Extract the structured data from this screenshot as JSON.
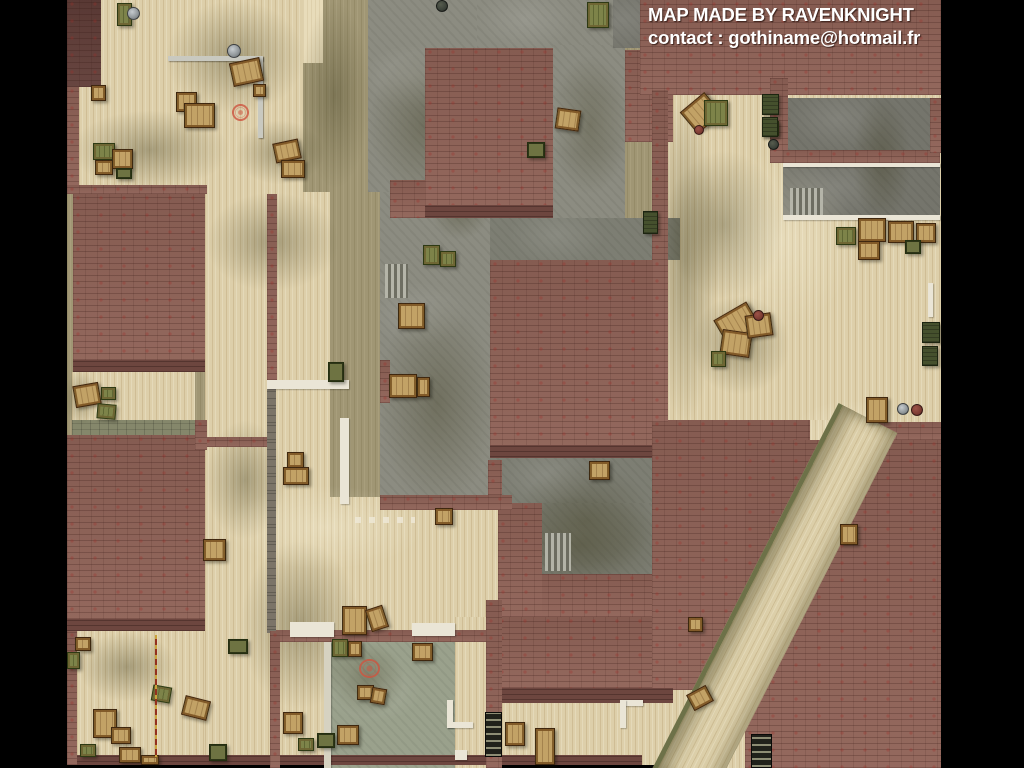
{
  "credits": {
    "line1": "MAP MADE BY RAVENKNIGHT",
    "line2": "contact : gothiname@hotmail.fr"
  },
  "palette": {
    "background": "#000000",
    "brick_roof": "#8d6156",
    "brick_dark": "#5e3c37",
    "wood_floor": "#ddcfaa",
    "olive_floor": "#a09674",
    "concrete": "#8c8c81",
    "concrete_green_room": "#9aa18c",
    "white_wall": "#eae5d6",
    "crate_tan": "#c2a266",
    "crate_green": "#7d8349",
    "marker_red": "#cd5540",
    "text": "#ffffff"
  },
  "map": {
    "width": 1024,
    "height": 768,
    "base": [
      67,
      0,
      874,
      765
    ],
    "floors": [
      [
        79,
        0,
        224,
        192,
        "bone"
      ],
      [
        303,
        0,
        20,
        63,
        "bone-light"
      ],
      [
        72,
        372,
        123,
        50,
        "bone"
      ],
      [
        72,
        420,
        123,
        16,
        "pave"
      ],
      [
        205,
        192,
        125,
        440,
        "bone"
      ],
      [
        77,
        631,
        193,
        126,
        "bone"
      ],
      [
        205,
        631,
        125,
        126,
        "bone"
      ],
      [
        205,
        497,
        447,
        134,
        "bone"
      ],
      [
        666,
        95,
        275,
        327,
        "bone"
      ],
      [
        502,
        703,
        255,
        62,
        "bone"
      ],
      [
        455,
        617,
        31,
        151,
        "bone"
      ],
      [
        655,
        655,
        100,
        113,
        "bone"
      ],
      [
        808,
        420,
        66,
        24,
        "bone"
      ]
    ],
    "concrete": [
      [
        368,
        0,
        122,
        192,
        "std"
      ],
      [
        380,
        192,
        110,
        305,
        "std"
      ],
      [
        477,
        0,
        140,
        48,
        "std"
      ],
      [
        553,
        45,
        72,
        196,
        "std"
      ],
      [
        490,
        218,
        190,
        42,
        "dark"
      ],
      [
        490,
        458,
        162,
        45,
        "dark"
      ],
      [
        542,
        503,
        110,
        71,
        "dark"
      ],
      [
        788,
        98,
        142,
        52,
        "room"
      ],
      [
        783,
        167,
        157,
        48,
        "room"
      ],
      [
        330,
        640,
        125,
        128,
        "green"
      ],
      [
        608,
        600,
        34,
        17,
        "std"
      ],
      [
        613,
        0,
        28,
        48,
        "room"
      ]
    ],
    "shadows": [
      [
        165,
        0,
        140,
        115
      ],
      [
        70,
        110,
        160,
        80
      ],
      [
        235,
        120,
        90,
        65
      ],
      [
        300,
        0,
        70,
        190
      ],
      [
        368,
        50,
        115,
        150
      ],
      [
        378,
        295,
        118,
        215
      ],
      [
        550,
        55,
        80,
        140
      ],
      [
        205,
        192,
        135,
        100
      ],
      [
        205,
        420,
        80,
        120
      ],
      [
        490,
        495,
        180,
        100
      ],
      [
        652,
        95,
        66,
        330
      ],
      [
        664,
        150,
        120,
        150
      ],
      [
        690,
        295,
        100,
        100
      ],
      [
        515,
        462,
        140,
        118
      ],
      [
        770,
        440,
        120,
        200
      ],
      [
        640,
        560,
        130,
        120
      ],
      [
        77,
        632,
        100,
        70
      ],
      [
        330,
        642,
        75,
        75
      ],
      [
        852,
        95,
        60,
        130
      ],
      [
        430,
        180,
        60,
        60
      ],
      [
        64,
        370,
        34,
        56
      ],
      [
        240,
        540,
        120,
        170
      ]
    ],
    "highlights": [
      [
        225,
        485,
        200,
        85
      ],
      [
        705,
        150,
        150,
        180
      ],
      [
        790,
        400,
        120,
        70
      ],
      [
        540,
        640,
        110,
        60
      ]
    ],
    "stairs": [
      [
        385,
        264,
        23,
        34
      ],
      [
        790,
        188,
        33,
        27
      ],
      [
        545,
        533,
        26,
        38
      ]
    ],
    "bricks": [
      [
        67,
        0,
        34,
        87,
        "dark"
      ],
      [
        67,
        87,
        12,
        101,
        ""
      ],
      [
        67,
        185,
        140,
        9,
        ""
      ],
      [
        73,
        194,
        132,
        178,
        ""
      ],
      [
        73,
        360,
        132,
        12,
        "edge"
      ],
      [
        67,
        435,
        138,
        196,
        ""
      ],
      [
        67,
        619,
        138,
        12,
        "edge"
      ],
      [
        203,
        437,
        64,
        10,
        ""
      ],
      [
        425,
        48,
        128,
        170,
        ""
      ],
      [
        425,
        205,
        128,
        13,
        "edge"
      ],
      [
        390,
        180,
        35,
        38,
        ""
      ],
      [
        625,
        50,
        48,
        92,
        ""
      ],
      [
        640,
        0,
        301,
        95,
        ""
      ],
      [
        490,
        260,
        167,
        198,
        ""
      ],
      [
        490,
        445,
        167,
        13,
        "edge"
      ],
      [
        652,
        420,
        158,
        270,
        ""
      ],
      [
        497,
        617,
        155,
        71,
        ""
      ],
      [
        497,
        688,
        176,
        15,
        "edge"
      ],
      [
        512,
        574,
        140,
        43,
        ""
      ],
      [
        498,
        503,
        44,
        114,
        ""
      ],
      [
        488,
        460,
        14,
        47,
        ""
      ],
      [
        745,
        440,
        196,
        328,
        ""
      ],
      [
        872,
        422,
        69,
        18,
        ""
      ],
      [
        770,
        78,
        18,
        85,
        ""
      ],
      [
        783,
        150,
        157,
        13,
        ""
      ],
      [
        930,
        98,
        11,
        55,
        ""
      ],
      [
        652,
        90,
        16,
        332,
        ""
      ],
      [
        380,
        360,
        10,
        43,
        ""
      ],
      [
        380,
        495,
        132,
        15,
        ""
      ],
      [
        67,
        755,
        575,
        10,
        "edge"
      ],
      [
        270,
        630,
        216,
        12,
        ""
      ],
      [
        486,
        600,
        16,
        168,
        ""
      ],
      [
        267,
        389,
        9,
        244,
        "stone"
      ],
      [
        267,
        194,
        10,
        186,
        ""
      ],
      [
        67,
        631,
        10,
        134,
        ""
      ],
      [
        270,
        631,
        10,
        137,
        ""
      ],
      [
        195,
        420,
        12,
        30,
        ""
      ]
    ],
    "whites": [
      [
        267,
        380,
        82,
        9,
        ""
      ],
      [
        340,
        418,
        9,
        86,
        ""
      ],
      [
        783,
        163,
        157,
        4,
        ""
      ],
      [
        783,
        215,
        157,
        5,
        ""
      ],
      [
        928,
        283,
        5,
        34,
        ""
      ],
      [
        290,
        622,
        44,
        15,
        ""
      ],
      [
        412,
        623,
        43,
        13,
        ""
      ],
      [
        447,
        700,
        6,
        28,
        ""
      ],
      [
        447,
        722,
        26,
        6,
        ""
      ],
      [
        620,
        700,
        23,
        6,
        ""
      ],
      [
        620,
        700,
        6,
        28,
        ""
      ],
      [
        455,
        750,
        12,
        10,
        ""
      ],
      [
        324,
        642,
        7,
        126,
        "dim"
      ]
    ],
    "pipes": [
      [
        168,
        56,
        95,
        5
      ],
      [
        258,
        56,
        5,
        82
      ]
    ],
    "diagonal_path": {
      "left": 835,
      "top": 418,
      "width": 66,
      "height": 410,
      "rotate_deg": 27
    },
    "crates": [
      [
        117,
        3,
        15,
        23,
        "green",
        0
      ],
      [
        176,
        92,
        21,
        20,
        "tan",
        0
      ],
      [
        184,
        103,
        31,
        25,
        "tan",
        0
      ],
      [
        231,
        60,
        31,
        24,
        "tan",
        -12
      ],
      [
        253,
        84,
        13,
        13,
        "tan",
        0
      ],
      [
        91,
        85,
        15,
        16,
        "tan",
        0
      ],
      [
        93,
        143,
        22,
        17,
        "green",
        0
      ],
      [
        95,
        160,
        18,
        15,
        "tan",
        0
      ],
      [
        112,
        149,
        21,
        20,
        "tan",
        0
      ],
      [
        116,
        168,
        16,
        11,
        "olive",
        0
      ],
      [
        274,
        141,
        26,
        20,
        "tan",
        -12
      ],
      [
        281,
        160,
        24,
        18,
        "tan",
        0
      ],
      [
        587,
        2,
        22,
        26,
        "green",
        0
      ],
      [
        556,
        109,
        24,
        21,
        "tan",
        8
      ],
      [
        527,
        142,
        18,
        16,
        "olive",
        0
      ],
      [
        423,
        245,
        17,
        20,
        "green",
        0
      ],
      [
        440,
        251,
        16,
        16,
        "green",
        0
      ],
      [
        398,
        303,
        27,
        26,
        "tan",
        0
      ],
      [
        389,
        374,
        28,
        24,
        "tan",
        0
      ],
      [
        417,
        377,
        13,
        20,
        "tan",
        0
      ],
      [
        328,
        362,
        16,
        20,
        "olive",
        0
      ],
      [
        287,
        452,
        17,
        16,
        "tan",
        0
      ],
      [
        283,
        467,
        26,
        18,
        "tan",
        0
      ],
      [
        203,
        539,
        23,
        22,
        "tan",
        0
      ],
      [
        342,
        606,
        25,
        29,
        "tan",
        0
      ],
      [
        368,
        607,
        18,
        23,
        "tan",
        -18
      ],
      [
        589,
        461,
        21,
        19,
        "tan",
        0
      ],
      [
        535,
        728,
        20,
        37,
        "tan",
        0
      ],
      [
        435,
        508,
        18,
        17,
        "tan",
        0
      ],
      [
        283,
        712,
        20,
        22,
        "tan",
        0
      ],
      [
        298,
        738,
        16,
        13,
        "green",
        0
      ],
      [
        685,
        99,
        32,
        28,
        "tan",
        -40
      ],
      [
        704,
        100,
        24,
        26,
        "green",
        0
      ],
      [
        762,
        121,
        17,
        15,
        "green",
        0
      ],
      [
        718,
        309,
        38,
        29,
        "tan",
        -30
      ],
      [
        721,
        331,
        30,
        25,
        "tan",
        8
      ],
      [
        746,
        314,
        26,
        23,
        "tan",
        -8
      ],
      [
        711,
        351,
        15,
        16,
        "green",
        0
      ],
      [
        866,
        397,
        22,
        26,
        "tan",
        0
      ],
      [
        840,
        524,
        18,
        21,
        "tan",
        0
      ],
      [
        762,
        94,
        17,
        21,
        "dark",
        0
      ],
      [
        762,
        117,
        16,
        20,
        "dark",
        0
      ],
      [
        922,
        322,
        18,
        21,
        "dark",
        0
      ],
      [
        922,
        346,
        16,
        20,
        "dark",
        0
      ],
      [
        643,
        211,
        15,
        23,
        "dark",
        0
      ],
      [
        836,
        227,
        20,
        18,
        "green",
        0
      ],
      [
        858,
        218,
        28,
        24,
        "tan",
        0
      ],
      [
        888,
        221,
        26,
        22,
        "tan",
        0
      ],
      [
        916,
        223,
        20,
        20,
        "tan",
        0
      ],
      [
        858,
        241,
        22,
        19,
        "tan",
        0
      ],
      [
        905,
        240,
        16,
        14,
        "olive",
        0
      ],
      [
        688,
        617,
        15,
        15,
        "tan",
        0
      ],
      [
        689,
        689,
        22,
        18,
        "tan",
        -28
      ],
      [
        74,
        384,
        26,
        22,
        "tan",
        -10
      ],
      [
        101,
        387,
        15,
        13,
        "green",
        0
      ],
      [
        97,
        404,
        19,
        15,
        "green",
        5
      ],
      [
        75,
        637,
        16,
        14,
        "tan",
        0
      ],
      [
        67,
        652,
        13,
        17,
        "green",
        0
      ],
      [
        228,
        639,
        20,
        15,
        "olive",
        0
      ],
      [
        93,
        709,
        24,
        29,
        "tan",
        0
      ],
      [
        111,
        727,
        20,
        17,
        "tan",
        0
      ],
      [
        80,
        744,
        16,
        13,
        "green",
        0
      ],
      [
        119,
        747,
        22,
        16,
        "tan",
        0
      ],
      [
        152,
        686,
        19,
        16,
        "green",
        10
      ],
      [
        183,
        698,
        26,
        20,
        "tan",
        14
      ],
      [
        209,
        744,
        18,
        17,
        "olive",
        0
      ],
      [
        141,
        755,
        18,
        10,
        "tan",
        0
      ],
      [
        332,
        639,
        16,
        18,
        "green",
        0
      ],
      [
        348,
        641,
        14,
        16,
        "tan",
        0
      ],
      [
        357,
        685,
        17,
        15,
        "tan",
        0
      ],
      [
        371,
        688,
        15,
        16,
        "tan",
        10
      ],
      [
        337,
        725,
        22,
        20,
        "tan",
        0
      ],
      [
        317,
        733,
        18,
        15,
        "olive",
        0
      ],
      [
        412,
        643,
        21,
        18,
        "tan",
        0
      ],
      [
        505,
        722,
        20,
        24,
        "tan",
        0
      ]
    ],
    "barrels": [
      [
        127,
        7,
        13,
        "gray"
      ],
      [
        227,
        44,
        14,
        "gray"
      ],
      [
        694,
        125,
        10,
        "maroon"
      ],
      [
        768,
        139,
        11,
        "dark"
      ],
      [
        753,
        310,
        11,
        "maroon"
      ],
      [
        897,
        403,
        12,
        "gray"
      ],
      [
        911,
        404,
        12,
        "maroon"
      ],
      [
        436,
        0,
        12,
        "dark"
      ]
    ],
    "ladders": [
      [
        485,
        712,
        17,
        45
      ],
      [
        751,
        734,
        21,
        34
      ]
    ],
    "hazard_lines": [
      [
        155,
        635,
        2,
        122
      ]
    ],
    "debris_rows": [
      [
        355,
        517,
        60,
        6
      ]
    ],
    "markers": [
      [
        232,
        104,
        17,
        17
      ],
      [
        359,
        659,
        21,
        19
      ]
    ]
  }
}
